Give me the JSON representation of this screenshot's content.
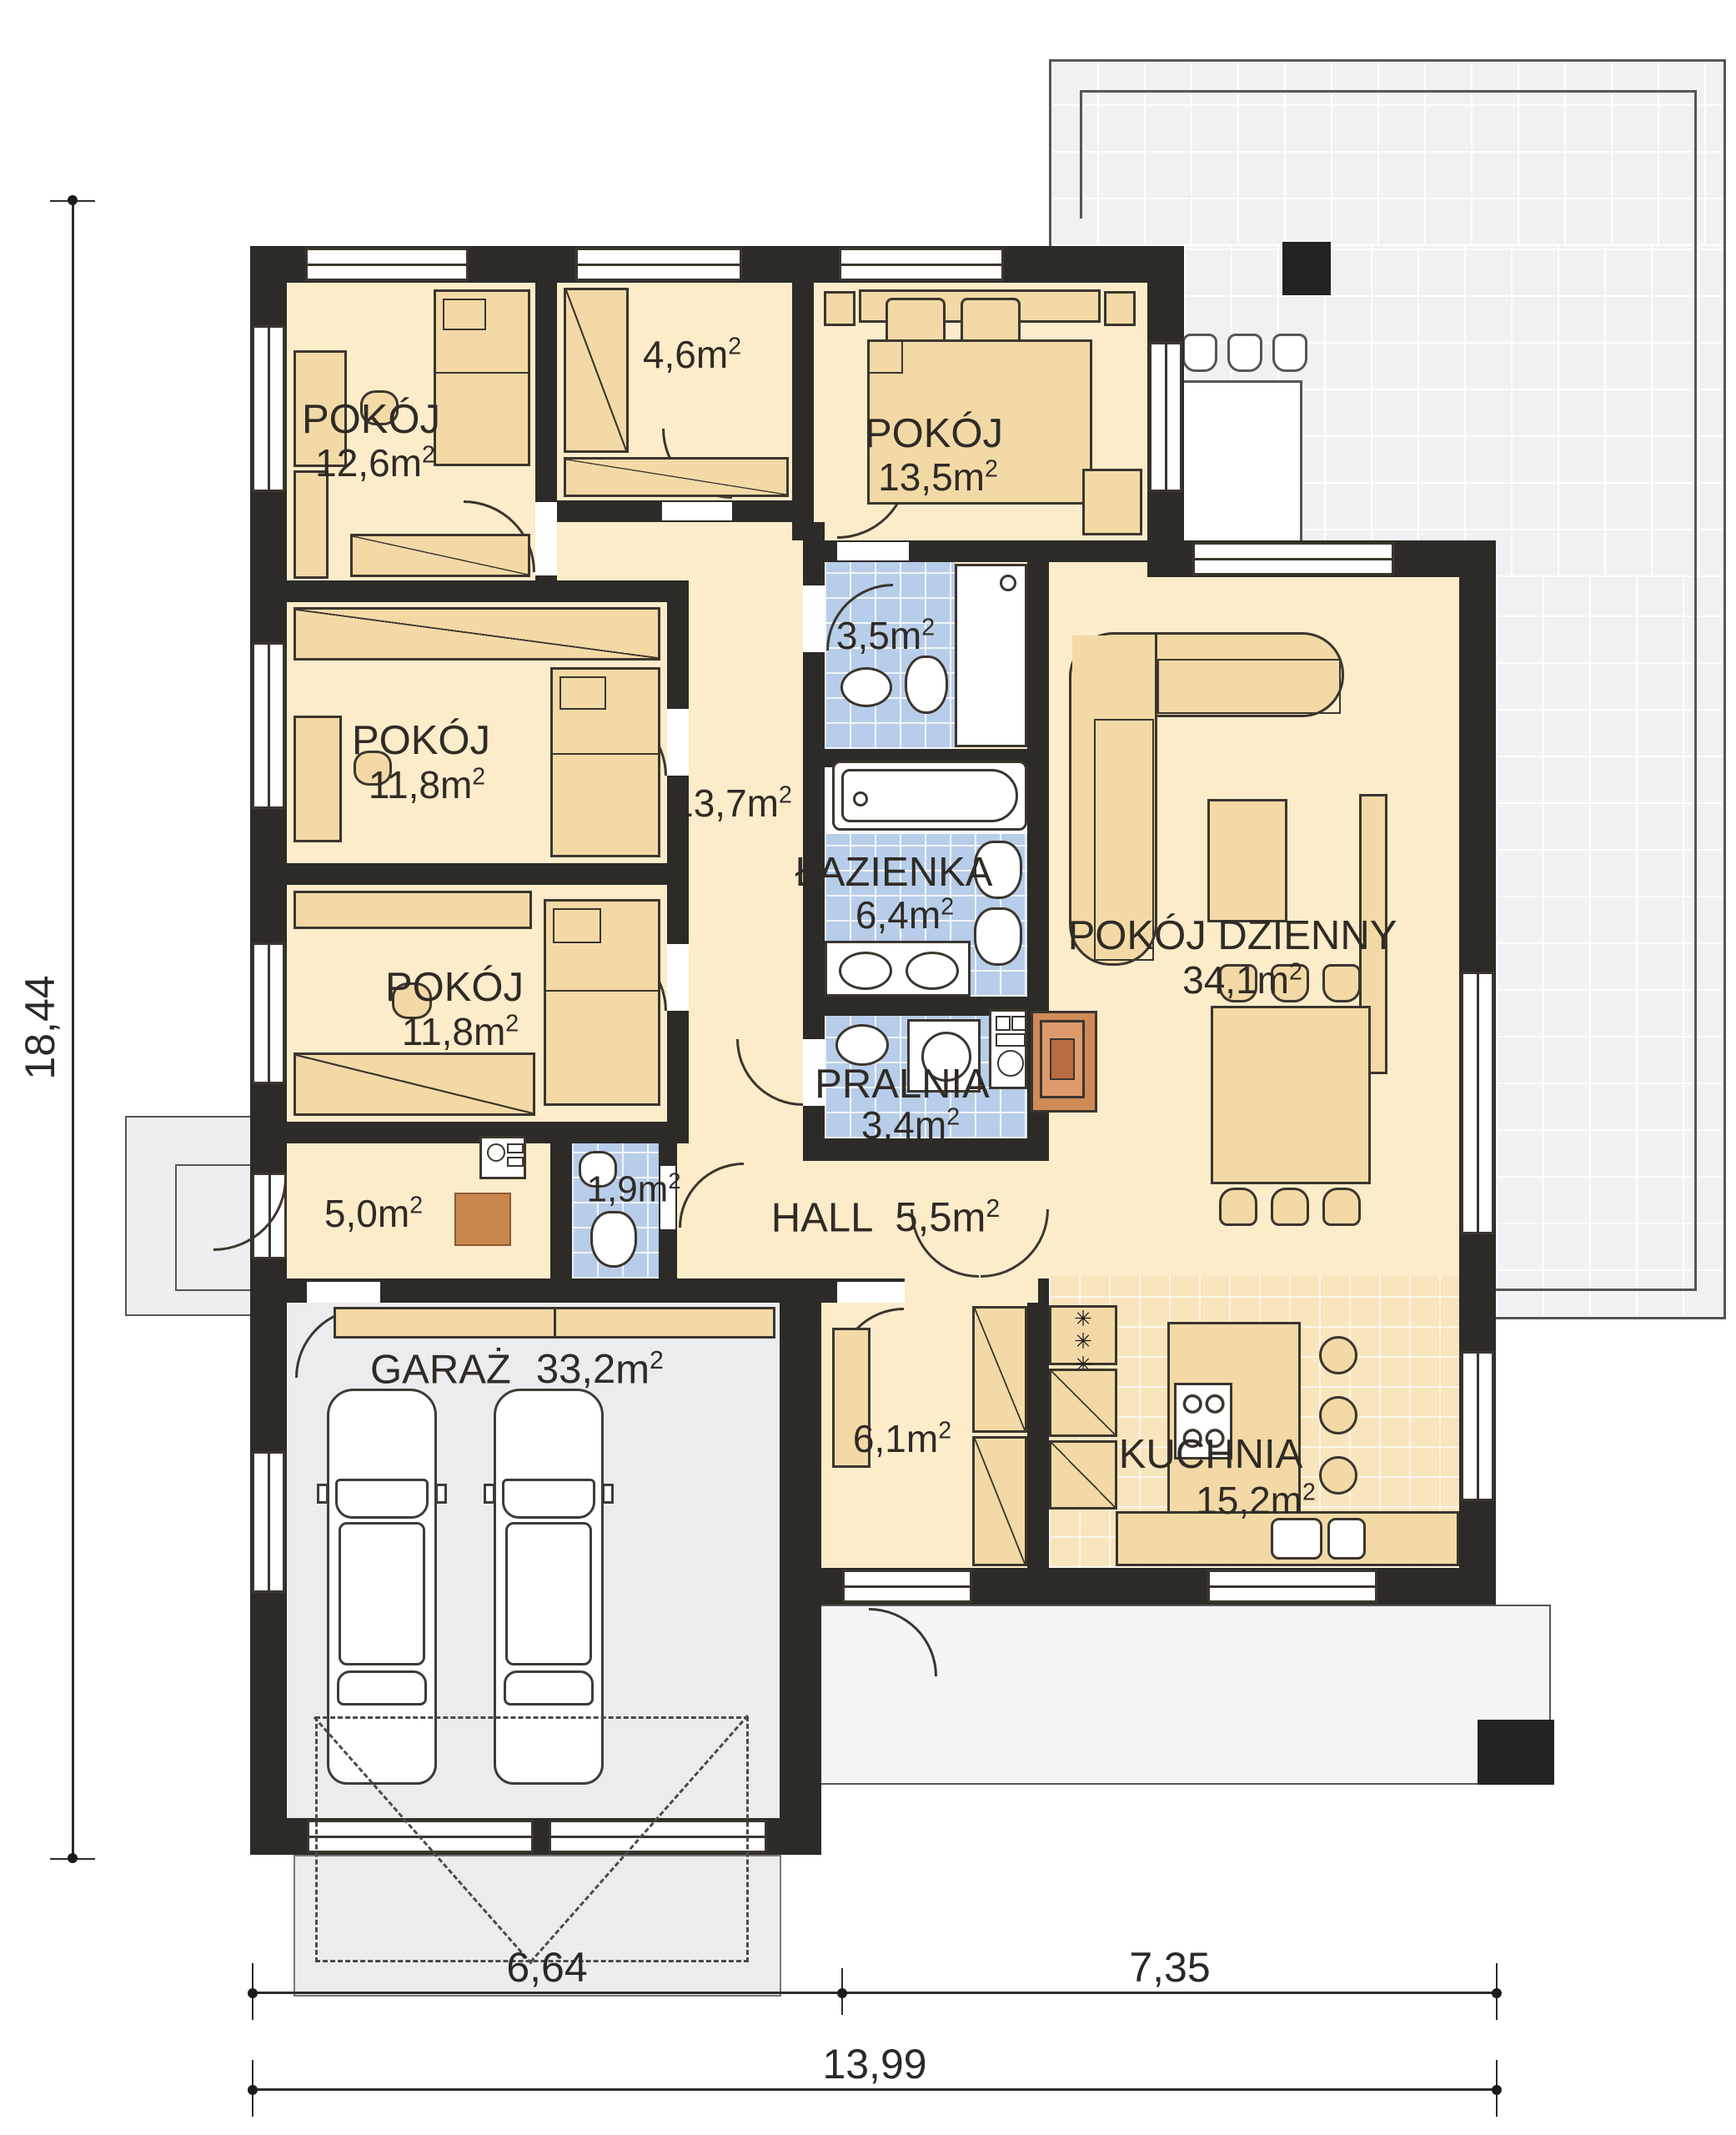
{
  "meta": {
    "unit": "m",
    "sup": "2"
  },
  "symbols": {
    "vent_char": "✳"
  },
  "colors": {
    "wall": "#2c2b28",
    "room_floor": "#fcecca",
    "bath_tile": "#b7cde9",
    "kitchen_tile": "#f8e5bd",
    "terrace": "#f1f1f3",
    "garage_floor": "#ececee",
    "furniture": "#f3d9a6",
    "fireplace": "#d08a58"
  },
  "rooms": {
    "pokoj_a": {
      "name": "POKÓJ",
      "area": "12,6"
    },
    "garderoba": {
      "area": "4,6"
    },
    "pokoj_b": {
      "name": "POKÓJ",
      "area": "13,5"
    },
    "wc": {
      "area": "3,5"
    },
    "korytarz": {
      "area": "13,7"
    },
    "pokoj_c": {
      "name": "POKÓJ",
      "area": "11,8"
    },
    "pokoj_d": {
      "name": "POKÓJ",
      "area": "11,8"
    },
    "lazienka": {
      "name": "ŁAZIENKA",
      "area": "6,4"
    },
    "salon": {
      "name": "POKÓJ DZIENNY",
      "area": "34,1"
    },
    "pralnia": {
      "name": "PRALNIA",
      "area": "3,4"
    },
    "wiatrolap": {
      "area": "5,0"
    },
    "wc_maly": {
      "area": "1,9"
    },
    "hall": {
      "name": "HALL",
      "area": "5,5"
    },
    "garaz": {
      "name": "GARAŻ",
      "area": "33,2"
    },
    "spizarnia": {
      "area": "6,1"
    },
    "kuchnia": {
      "name": "KUCHNIA",
      "area": "15,2"
    }
  },
  "dimensions": {
    "height_total": "18,44",
    "width_left": "6,64",
    "width_right": "7,35",
    "width_total": "13,99"
  }
}
